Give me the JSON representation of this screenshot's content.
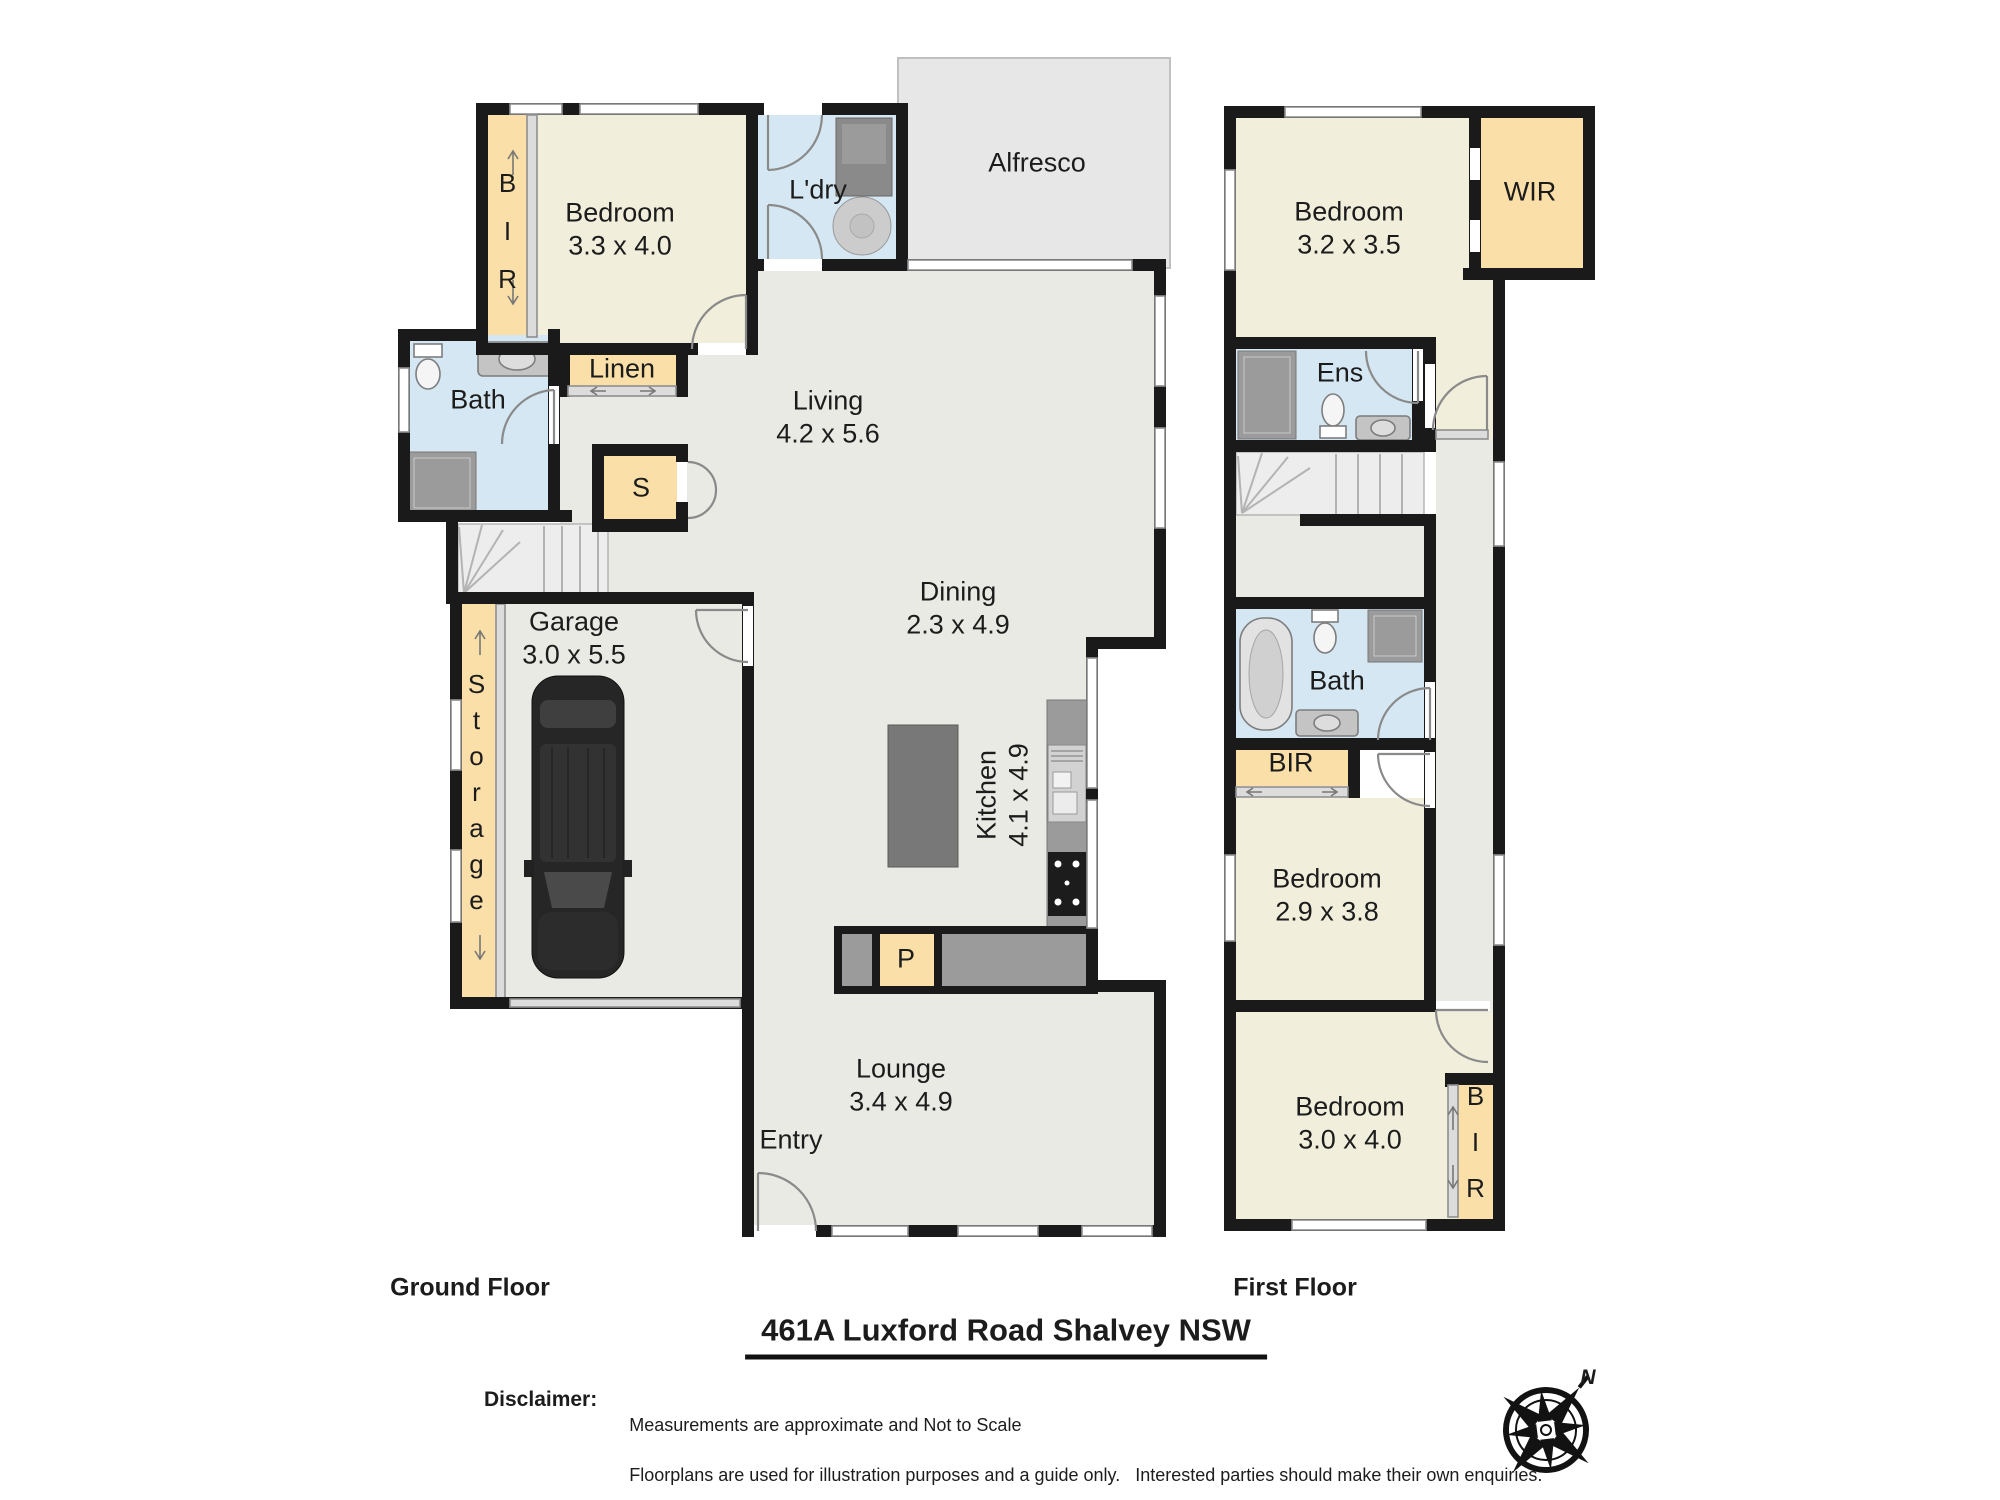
{
  "ground": {
    "floor_label": "Ground Floor",
    "rooms": {
      "bedroom": {
        "name": "Bedroom",
        "dims": "3.3 x 4.0"
      },
      "living": {
        "name": "Living",
        "dims": "4.2 x 5.6"
      },
      "dining": {
        "name": "Dining",
        "dims": "2.3 x 4.9"
      },
      "kitchen": {
        "name": "Kitchen",
        "dims": "4.1 x 4.9"
      },
      "garage": {
        "name": "Garage",
        "dims": "3.0 x 5.5"
      },
      "lounge": {
        "name": "Lounge",
        "dims": "3.4 x 4.9"
      },
      "alfresco": "Alfresco",
      "laundry": "L'dry",
      "bath": "Bath",
      "linen": "Linen",
      "store_cupboard": "S",
      "storage": "Storage",
      "pantry": "P",
      "entry": "Entry",
      "bir": "BIR"
    }
  },
  "first": {
    "floor_label": "First Floor",
    "rooms": {
      "bedroom1": {
        "name": "Bedroom",
        "dims": "3.2 x 3.5"
      },
      "bedroom2": {
        "name": "Bedroom",
        "dims": "2.9 x 3.8"
      },
      "bedroom3": {
        "name": "Bedroom",
        "dims": "3.0 x 4.0"
      },
      "wir": "WIR",
      "ens": "Ens",
      "bath": "Bath",
      "bir_hall": "BIR",
      "bir_bedroom": "BIR"
    }
  },
  "footer": {
    "address": "461A Luxford Road Shalvey  NSW",
    "disclaimer_label": "Disclaimer:",
    "disclaimer_line1": "Measurements are approximate and Not to Scale",
    "disclaimer_line2": "Floorplans are used for illustration purposes and a guide only.   Interested parties should make their own enquiries.",
    "compass_north": "N"
  },
  "colors": {
    "wall": "#1a1a1a",
    "room_cream": "#f1eedb",
    "closet_tan": "#fadfa8",
    "wet_blue": "#d5e7f2",
    "floor_grey": "#e9eae4",
    "alfresco_grey": "#e7e7e7"
  }
}
